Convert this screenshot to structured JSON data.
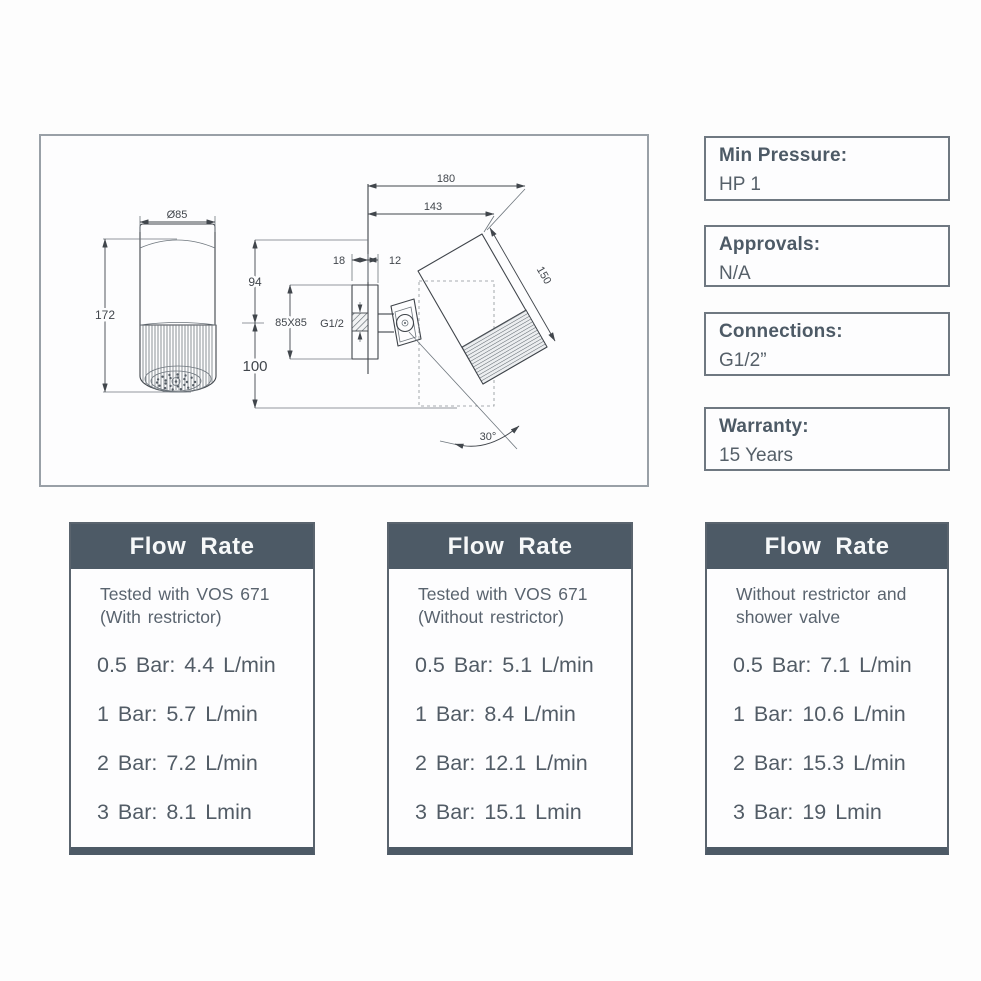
{
  "colors": {
    "accent_slate": "#4d5a66",
    "line": "#41464c",
    "box_border": "#6f7881",
    "body_text": "#59636e"
  },
  "drawing": {
    "description": "technical-drawing-wall-mounted-shower-head",
    "dims": {
      "dia": "Ø85",
      "height": "172",
      "d180": "180",
      "d143": "143",
      "d18": "18",
      "d12": "12",
      "d94": "94",
      "d150": "150",
      "plate": "85X85",
      "thread": "G1/2",
      "d100": "100",
      "angle": "30°"
    }
  },
  "info_boxes": [
    {
      "label": "Min Pressure:",
      "value": "HP 1"
    },
    {
      "label": "Approvals:",
      "value": "N/A"
    },
    {
      "label": "Connections:",
      "value": "G1/2”"
    },
    {
      "label": "Warranty:",
      "value": "15 Years"
    }
  ],
  "flow_tables": [
    {
      "header": "Flow Rate",
      "note1": "Tested with VOS 671",
      "note2": "(With restrictor)",
      "rows": [
        "0.5 Bar: 4.4 L/min",
        "1 Bar: 5.7 L/min",
        "2 Bar: 7.2 L/min",
        "3 Bar: 8.1 Lmin"
      ]
    },
    {
      "header": "Flow Rate",
      "note1": "Tested with VOS 671",
      "note2": "(Without restrictor)",
      "rows": [
        "0.5 Bar: 5.1 L/min",
        "1 Bar: 8.4 L/min",
        "2 Bar: 12.1 L/min",
        "3 Bar: 15.1 Lmin"
      ]
    },
    {
      "header": "Flow Rate",
      "note1": "Without restrictor and",
      "note2": "shower valve",
      "rows": [
        "0.5 Bar: 7.1 L/min",
        "1 Bar: 10.6 L/min",
        "2 Bar: 15.3 L/min",
        "3 Bar: 19 Lmin"
      ]
    }
  ]
}
